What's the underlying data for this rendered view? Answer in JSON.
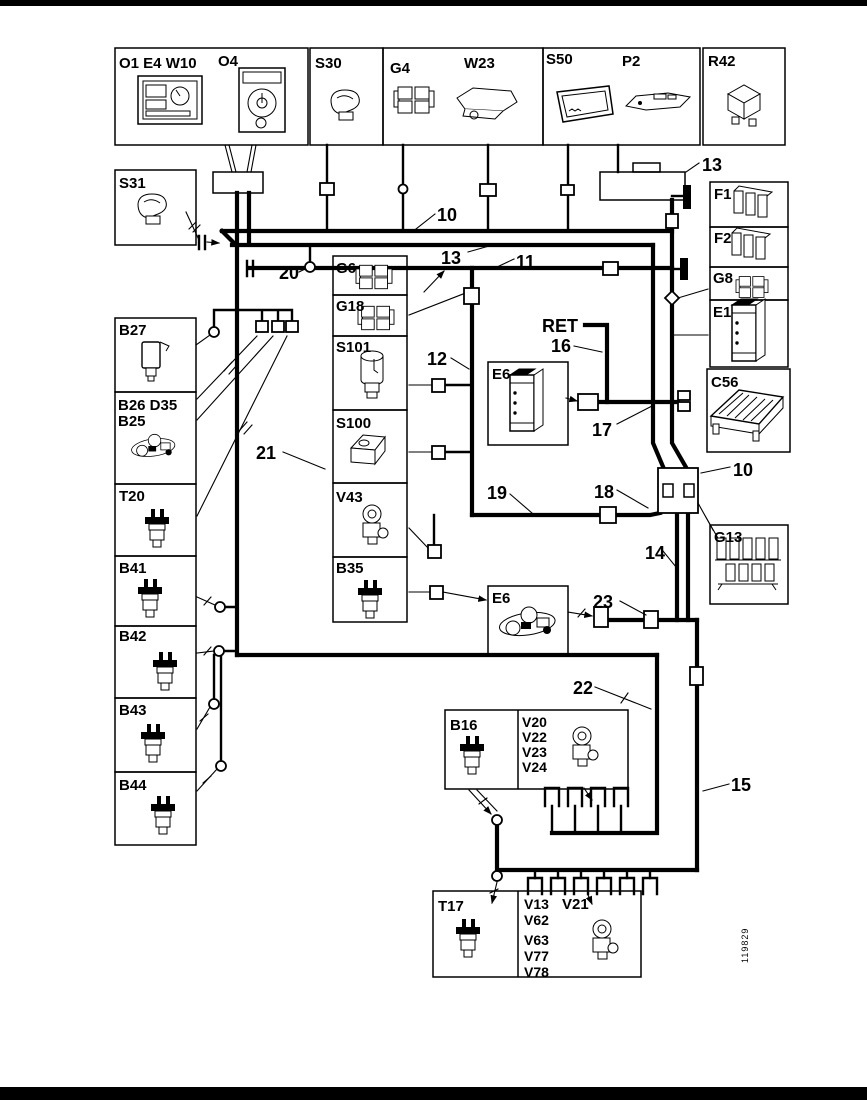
{
  "components": {
    "o1e4w10": "O1 E4 W10",
    "o4": "O4",
    "s30": "S30",
    "g4": "G4",
    "w23": "W23",
    "s50": "S50",
    "p2": "P2",
    "r42": "R42",
    "s31": "S31",
    "f1": "F1",
    "f2": "F2",
    "g8": "G8",
    "e1": "E1",
    "c56": "C56",
    "g13": "G13",
    "b27": "B27",
    "b26d35_line1": "B26 D35",
    "b26d35_line2": "B25",
    "t20": "T20",
    "b41": "B41",
    "b42": "B42",
    "b43": "B43",
    "b44": "B44",
    "g6": "G6",
    "g18": "G18",
    "s101": "S101",
    "s100": "S100",
    "v43": "V43",
    "b35": "B35",
    "e6_upper": "E6",
    "e6_lower": "E6",
    "b16": "B16",
    "v20": "V20",
    "v22": "V22",
    "v23": "V23",
    "v24": "V24",
    "t17": "T17",
    "v13": "V13",
    "v62": "V62",
    "v63": "V63",
    "v77": "V77",
    "v78": "V78",
    "v21": "V21"
  },
  "wires": {
    "n10_top": "10",
    "n13_top": "13",
    "n13_mid": "13",
    "n11": "11",
    "n12": "12",
    "n20": "20",
    "n21": "21",
    "ret": "RET",
    "n16": "16",
    "n17": "17",
    "n19": "19",
    "n18": "18",
    "n10_right": "10",
    "n14": "14",
    "n23": "23",
    "n22": "22",
    "n15": "15"
  },
  "meta": {
    "doc_number": "119829"
  }
}
